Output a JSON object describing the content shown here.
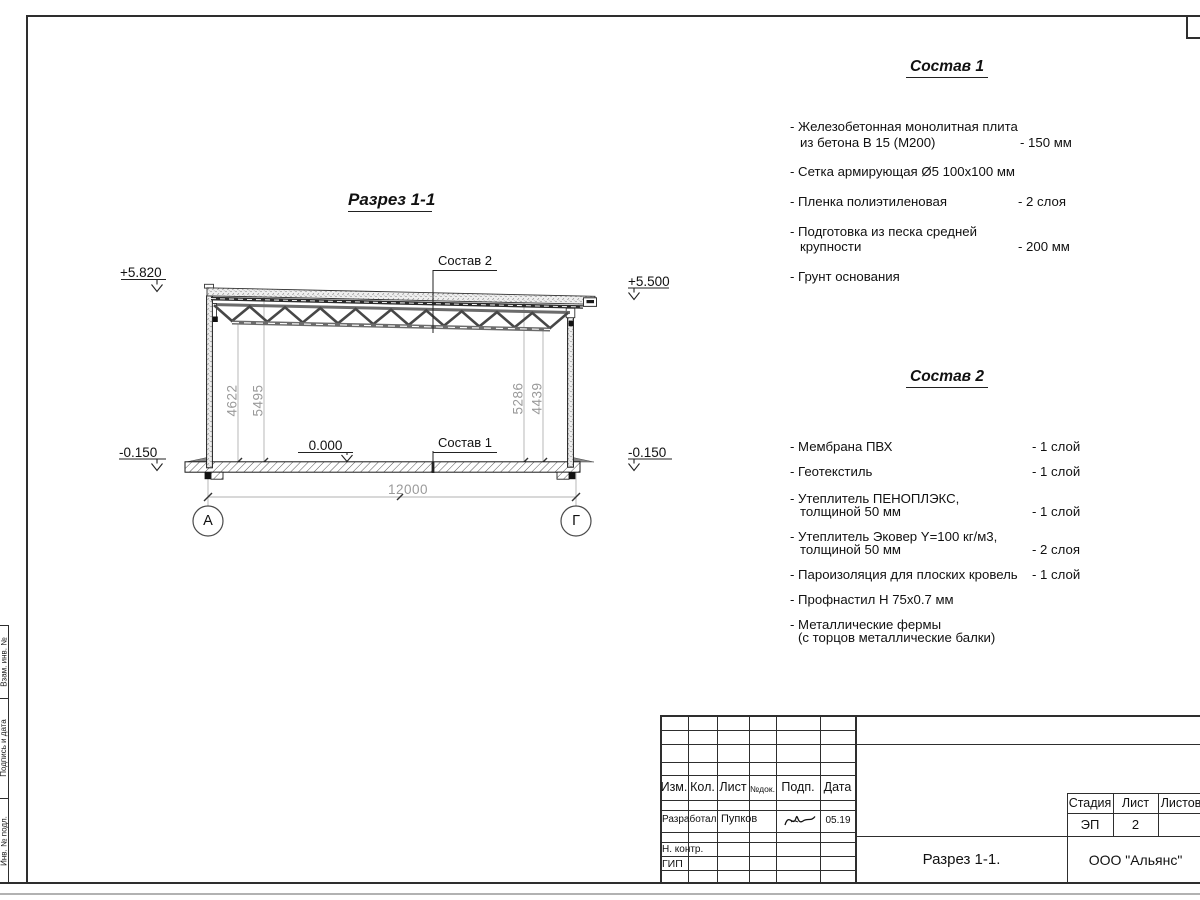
{
  "drawing": {
    "title": "Разрез 1-1",
    "labels": {
      "roof_leader": "Состав 2",
      "floor_leader": "Состав 1"
    },
    "elevations": {
      "top_left": "+5.820",
      "top_right": "+5.500",
      "bottom_left": "-0.150",
      "bottom_right": "-0.150",
      "floor": "0.000"
    },
    "dims": {
      "span": "12000",
      "left_inner": "4622",
      "left_outer": "5495",
      "right_outer": "5286",
      "right_inner": "4439"
    },
    "axes": {
      "left": "А",
      "right": "Г"
    }
  },
  "comp1": {
    "title": "Состав 1",
    "items": [
      {
        "l1": "- Железобетонная  монолитная плита",
        "l2": "из бетона В 15 (М200)",
        "val": "- 150 мм"
      },
      {
        "l1": "- Сетка армирующая Ø5 100х100 мм",
        "l2": "",
        "val": ""
      },
      {
        "l1": "- Пленка полиэтиленовая",
        "l2": "",
        "val": "-  2 слоя"
      },
      {
        "l1": "- Подготовка из песка средней",
        "l2": "крупности",
        "val": "- 200 мм"
      },
      {
        "l1": "- Грунт основания",
        "l2": "",
        "val": ""
      }
    ]
  },
  "comp2": {
    "title": "Состав 2",
    "items": [
      {
        "l1": "- Мембрана ПВХ",
        "l2": "",
        "val": "- 1 слой"
      },
      {
        "l1": "- Геотекстиль",
        "l2": "",
        "val": "- 1 слой"
      },
      {
        "l1": "- Утеплитель ПЕНОПЛЭКС,",
        "l2": "толщиной 50 мм",
        "val": "- 1 слой"
      },
      {
        "l1": "- Утеплитель Эковер Y=100 кг/м3,",
        "l2": "толщиной 50 мм",
        "val": "- 2 слоя"
      },
      {
        "l1": "- Пароизоляция для плоских кровель",
        "l2": "",
        "val": "- 1 слой"
      },
      {
        "l1": "- Профнастил Н 75х0.7 мм",
        "l2": "",
        "val": ""
      },
      {
        "l1": "- Металлические фермы",
        "l2": "(с торцов металлические балки)",
        "val": ""
      }
    ]
  },
  "titleblock": {
    "headers": {
      "izm": "Изм.",
      "kol": "Кол.",
      "list": "Лист",
      "ndoc": "№док.",
      "podp": "Подп.",
      "data": "Дата"
    },
    "rows": {
      "developed_label": "Разработал",
      "developed_name": "Пупков",
      "developed_date": "05.19",
      "ncontr_label": "Н. контр.",
      "gip_label": "ГИП"
    },
    "stage_header": "Стадия",
    "sheet_header": "Лист",
    "sheets_header": "Листов",
    "stage_value": "ЭП",
    "sheet_value": "2",
    "doc_name": "Разрез 1-1.",
    "company": "ООО \"Альянс\""
  },
  "margin": {
    "box1": "Взам. инв. №",
    "box2": "Подпись и дата",
    "box3": "Инв. № подл."
  }
}
